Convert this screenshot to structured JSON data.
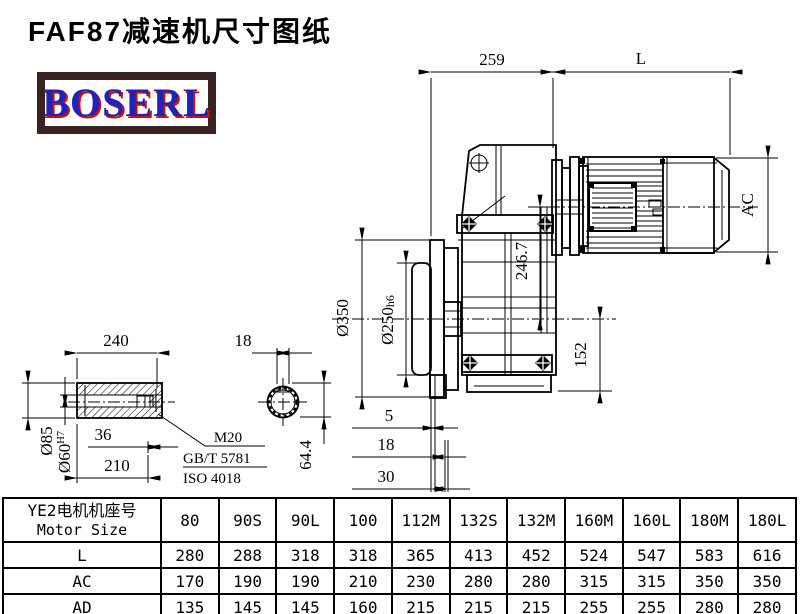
{
  "title": "FAF87减速机尺寸图纸",
  "logo": "BOSERL",
  "colors": {
    "logo-border": "#3a2222",
    "logo-blue": "#2222bb",
    "logo-red": "#cc1100"
  },
  "dims": {
    "top_width": "259",
    "motor_length": "L",
    "motor_diameter": "AC",
    "flange_od": "Ø350",
    "spigot": "Ø250",
    "spigot_tol": "h6",
    "axis_height": "246.7",
    "bottom_height": "152",
    "t5": "5",
    "t18": "18",
    "t30": "30"
  },
  "shaft": {
    "length": "240",
    "od": "Ø85",
    "bore": "Ø60",
    "bore_tol": "H7",
    "bolt_depth": "36",
    "bore_depth": "210",
    "thread": "M20",
    "std1": "GB/T 5781",
    "std2": "ISO 4018",
    "key_width": "18",
    "key_height": "64.4"
  },
  "table": {
    "header_cn": "YE2电机机座号",
    "header_en": "Motor Size",
    "columns": [
      "80",
      "90S",
      "90L",
      "100",
      "112M",
      "132S",
      "132M",
      "160M",
      "160L",
      "180M",
      "180L"
    ],
    "rows": [
      {
        "label": "L",
        "values": [
          "280",
          "288",
          "318",
          "318",
          "365",
          "413",
          "452",
          "524",
          "547",
          "583",
          "616"
        ]
      },
      {
        "label": "AC",
        "values": [
          "170",
          "190",
          "190",
          "210",
          "230",
          "280",
          "280",
          "315",
          "315",
          "350",
          "350"
        ]
      },
      {
        "label": "AD",
        "values": [
          "135",
          "145",
          "145",
          "160",
          "215",
          "215",
          "215",
          "255",
          "255",
          "280",
          "280"
        ]
      }
    ]
  }
}
